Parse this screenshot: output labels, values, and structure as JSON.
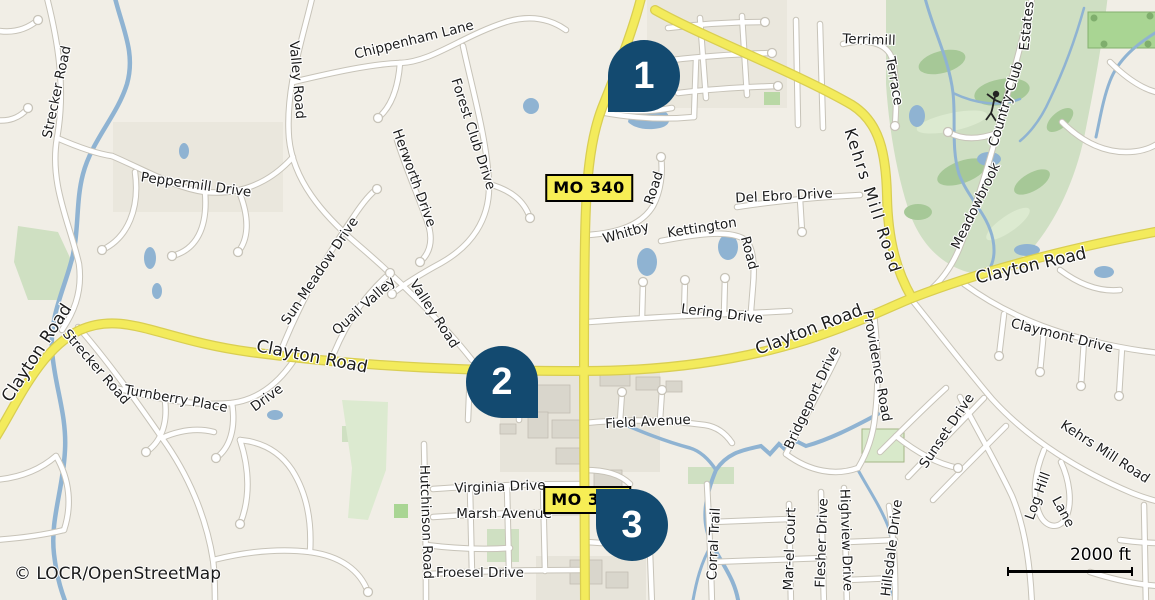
{
  "map": {
    "attribution": "© LOCR/OpenStreetMap",
    "scale_bar": {
      "label": "2000 ft"
    },
    "colors": {
      "marker_fill": "#134a70",
      "marker_text": "#ffffff",
      "badge_bg": "#f7ee55",
      "road_major_yellow": "#f3eb5c",
      "water_blue": "#8fb3d2",
      "golf_green": "#cfdfc3",
      "land": "#f1eee6"
    },
    "route_badges": [
      {
        "name": "mo-340-badge-north",
        "text": "MO 340",
        "x": 589,
        "y": 188
      },
      {
        "name": "mo-340-badge-south",
        "text": "MO 340",
        "x": 587,
        "y": 500
      }
    ],
    "markers": [
      {
        "name": "map-marker-1",
        "number": "1",
        "cx": 644,
        "cy": 76,
        "tip": "bl"
      },
      {
        "name": "map-marker-2",
        "number": "2",
        "cx": 502,
        "cy": 382,
        "tip": "br"
      },
      {
        "name": "map-marker-3",
        "number": "3",
        "cx": 632,
        "cy": 525,
        "tip": "tl"
      }
    ],
    "road_labels": [
      {
        "n": "strecker-road-n",
        "t": "Strecker Road",
        "x": 57,
        "y": 92,
        "r": -78
      },
      {
        "n": "peppermill-drive",
        "t": "Peppermill Drive",
        "x": 196,
        "y": 185,
        "r": 8
      },
      {
        "n": "valley-road-n",
        "t": "Valley Road",
        "x": 297,
        "y": 80,
        "r": 85
      },
      {
        "n": "chippenham-lane",
        "t": "Chippenham Lane",
        "x": 414,
        "y": 40,
        "r": -14
      },
      {
        "n": "forest-club-drive",
        "t": "Forest Club Drive",
        "x": 473,
        "y": 134,
        "r": 72
      },
      {
        "n": "herworth-drive",
        "t": "Herworth Drive",
        "x": 414,
        "y": 178,
        "r": 70
      },
      {
        "n": "sun-meadow-drive",
        "t": "Sun Meadow Drive",
        "x": 320,
        "y": 271,
        "r": -56
      },
      {
        "n": "quail-valley",
        "t": "Quail Valley",
        "x": 364,
        "y": 306,
        "r": -42
      },
      {
        "n": "valley-road-mid",
        "t": "Valley Road",
        "x": 434,
        "y": 314,
        "r": 57
      },
      {
        "n": "clayton-road-w-edge",
        "t": "Clayton Road",
        "x": 37,
        "y": 353,
        "r": -57,
        "fs": 17
      },
      {
        "n": "strecker-road-s",
        "t": "Strecker Road",
        "x": 96,
        "y": 367,
        "r": 49
      },
      {
        "n": "turnberry-place",
        "t": "Turnberry Place",
        "x": 176,
        "y": 399,
        "r": 10
      },
      {
        "n": "turnberry-drive",
        "t": "Drive",
        "x": 267,
        "y": 398,
        "r": -36
      },
      {
        "n": "clayton-road-w",
        "t": "Clayton Road",
        "x": 312,
        "y": 357,
        "r": 11,
        "fs": 17
      },
      {
        "n": "clayton-road-e",
        "t": "Clayton Road",
        "x": 809,
        "y": 330,
        "r": -21,
        "fs": 17
      },
      {
        "n": "clayton-road-ne",
        "t": "Clayton Road",
        "x": 1031,
        "y": 266,
        "r": -13,
        "fs": 17
      },
      {
        "n": "hutchinson-road",
        "t": "Hutchinson Road",
        "x": 426,
        "y": 522,
        "r": 88
      },
      {
        "n": "virginia-drive",
        "t": "Virginia Drive",
        "x": 500,
        "y": 487,
        "r": -2
      },
      {
        "n": "marsh-avenue",
        "t": "Marsh Avenue",
        "x": 504,
        "y": 514,
        "r": 0
      },
      {
        "n": "froesel-drive",
        "t": "Froesel Drive",
        "x": 480,
        "y": 573,
        "r": 0
      },
      {
        "n": "field-avenue",
        "t": "Field Avenue",
        "x": 648,
        "y": 422,
        "r": -3
      },
      {
        "n": "lering-drive",
        "t": "Lering Drive",
        "x": 722,
        "y": 314,
        "r": 7
      },
      {
        "n": "whitby-road-1",
        "t": "Whitby",
        "x": 626,
        "y": 233,
        "r": -16
      },
      {
        "n": "whitby-road-2",
        "t": "Road",
        "x": 654,
        "y": 188,
        "r": -72
      },
      {
        "n": "kettington-road-1",
        "t": "Kettington",
        "x": 702,
        "y": 228,
        "r": -9
      },
      {
        "n": "kettington-road-2",
        "t": "Road",
        "x": 749,
        "y": 253,
        "r": 75
      },
      {
        "n": "del-ebro-drive",
        "t": "Del Ebro Drive",
        "x": 784,
        "y": 196,
        "r": -3
      },
      {
        "n": "terrimill-terrace-1",
        "t": "Terrimill",
        "x": 869,
        "y": 40,
        "r": 2
      },
      {
        "n": "terrimill-terrace-2",
        "t": "Terrace",
        "x": 894,
        "y": 81,
        "r": 80
      },
      {
        "n": "kehrs-mill-road-n",
        "t": "Kehrs Mill Road",
        "x": 873,
        "y": 201,
        "r": 72,
        "fs": 16,
        "ls": 2
      },
      {
        "n": "meadowbrook-1",
        "t": "Meadowbrook",
        "x": 976,
        "y": 206,
        "r": -64
      },
      {
        "n": "meadowbrook-2",
        "t": "Country Club",
        "x": 1006,
        "y": 104,
        "r": -73
      },
      {
        "n": "meadowbrook-3",
        "t": "Estates",
        "x": 1027,
        "y": 26,
        "r": -84
      },
      {
        "n": "claymont-drive",
        "t": "Claymont Drive",
        "x": 1062,
        "y": 336,
        "r": 14
      },
      {
        "n": "providence-road",
        "t": "Providence Road",
        "x": 877,
        "y": 366,
        "r": 80
      },
      {
        "n": "bridgeport-drive",
        "t": "Bridgeport Drive",
        "x": 812,
        "y": 398,
        "r": -65
      },
      {
        "n": "sunset-drive",
        "t": "Sunset Drive",
        "x": 947,
        "y": 431,
        "r": -56
      },
      {
        "n": "kehrs-mill-road-s",
        "t": "Kehrs Mill Road",
        "x": 1105,
        "y": 452,
        "r": 33
      },
      {
        "n": "log-hill-lane-1",
        "t": "Log Hill",
        "x": 1038,
        "y": 496,
        "r": -70
      },
      {
        "n": "log-hill-lane-2",
        "t": "Lane",
        "x": 1063,
        "y": 512,
        "r": 62
      },
      {
        "n": "corral-trail",
        "t": "Corral Trail",
        "x": 714,
        "y": 544,
        "r": -87
      },
      {
        "n": "mar-el-court",
        "t": "Mar-el Court",
        "x": 790,
        "y": 549,
        "r": -88
      },
      {
        "n": "flesher-drive",
        "t": "Flesher Drive",
        "x": 822,
        "y": 543,
        "r": -88
      },
      {
        "n": "highview-drive",
        "t": "Highview Drive",
        "x": 846,
        "y": 540,
        "r": 88
      },
      {
        "n": "hillsdale-drive",
        "t": "Hillsdale Drive",
        "x": 892,
        "y": 548,
        "r": -83
      }
    ]
  }
}
